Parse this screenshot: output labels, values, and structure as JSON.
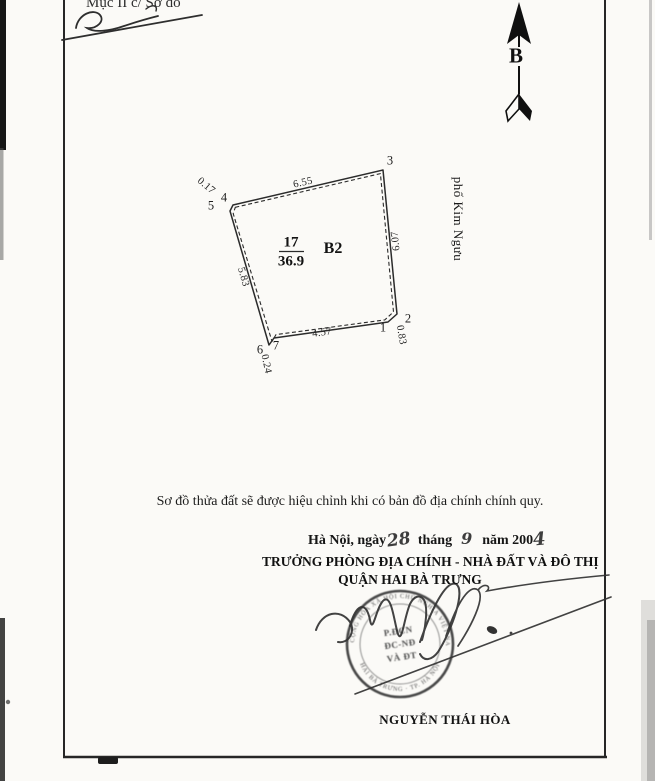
{
  "header": {
    "section_label": "Mục II c/ Sơ đồ"
  },
  "compass": {
    "north_label": "B"
  },
  "plot": {
    "parcel_number": "17",
    "area_m2": "36.9",
    "block_label": "B2",
    "street_name": "phố Kim Ngưu",
    "vertex_labels": {
      "v1": "1",
      "v2": "2",
      "v3": "3",
      "v4": "4",
      "v5": "5",
      "v6": "6",
      "v7": "7"
    },
    "dimensions_m": {
      "top": "6.55",
      "right": "6.07",
      "bottom": "4.57",
      "left": "5.83",
      "top_left_jog": "0.17",
      "bottom_right_jog": "0.83",
      "bottom_left_jog": "0.24"
    }
  },
  "note": "Sơ đồ thửa đất sẽ được hiệu chỉnh khi có bản đồ địa chính chính quy.",
  "date_line": {
    "place_prefix": "Hà Nội, ngày",
    "day_handwritten": "28",
    "month_label": "tháng",
    "month_handwritten": "9",
    "year_label": "năm 200",
    "year_digit_handwritten": "4"
  },
  "signature_block": {
    "title_line1": "TRƯỞNG PHÒNG ĐỊA CHÍNH - NHÀ ĐẤT VÀ ĐÔ THỊ",
    "title_line2": "QUẬN HAI BÀ TRƯNG",
    "signer_name": "NGUYỄN THÁI HÒA"
  },
  "stamp": {
    "rim_text_top": "CỘNG HÒA XÃ HỘI CHỦ NGHĨA VIỆT NAM",
    "rim_text_bottom": "HAI BÀ TRƯNG · TP. HÀ NỘI",
    "center_line1": "P.ĐCN",
    "center_line2": "ĐC-NĐ",
    "center_line3": "VÀ ĐT"
  }
}
